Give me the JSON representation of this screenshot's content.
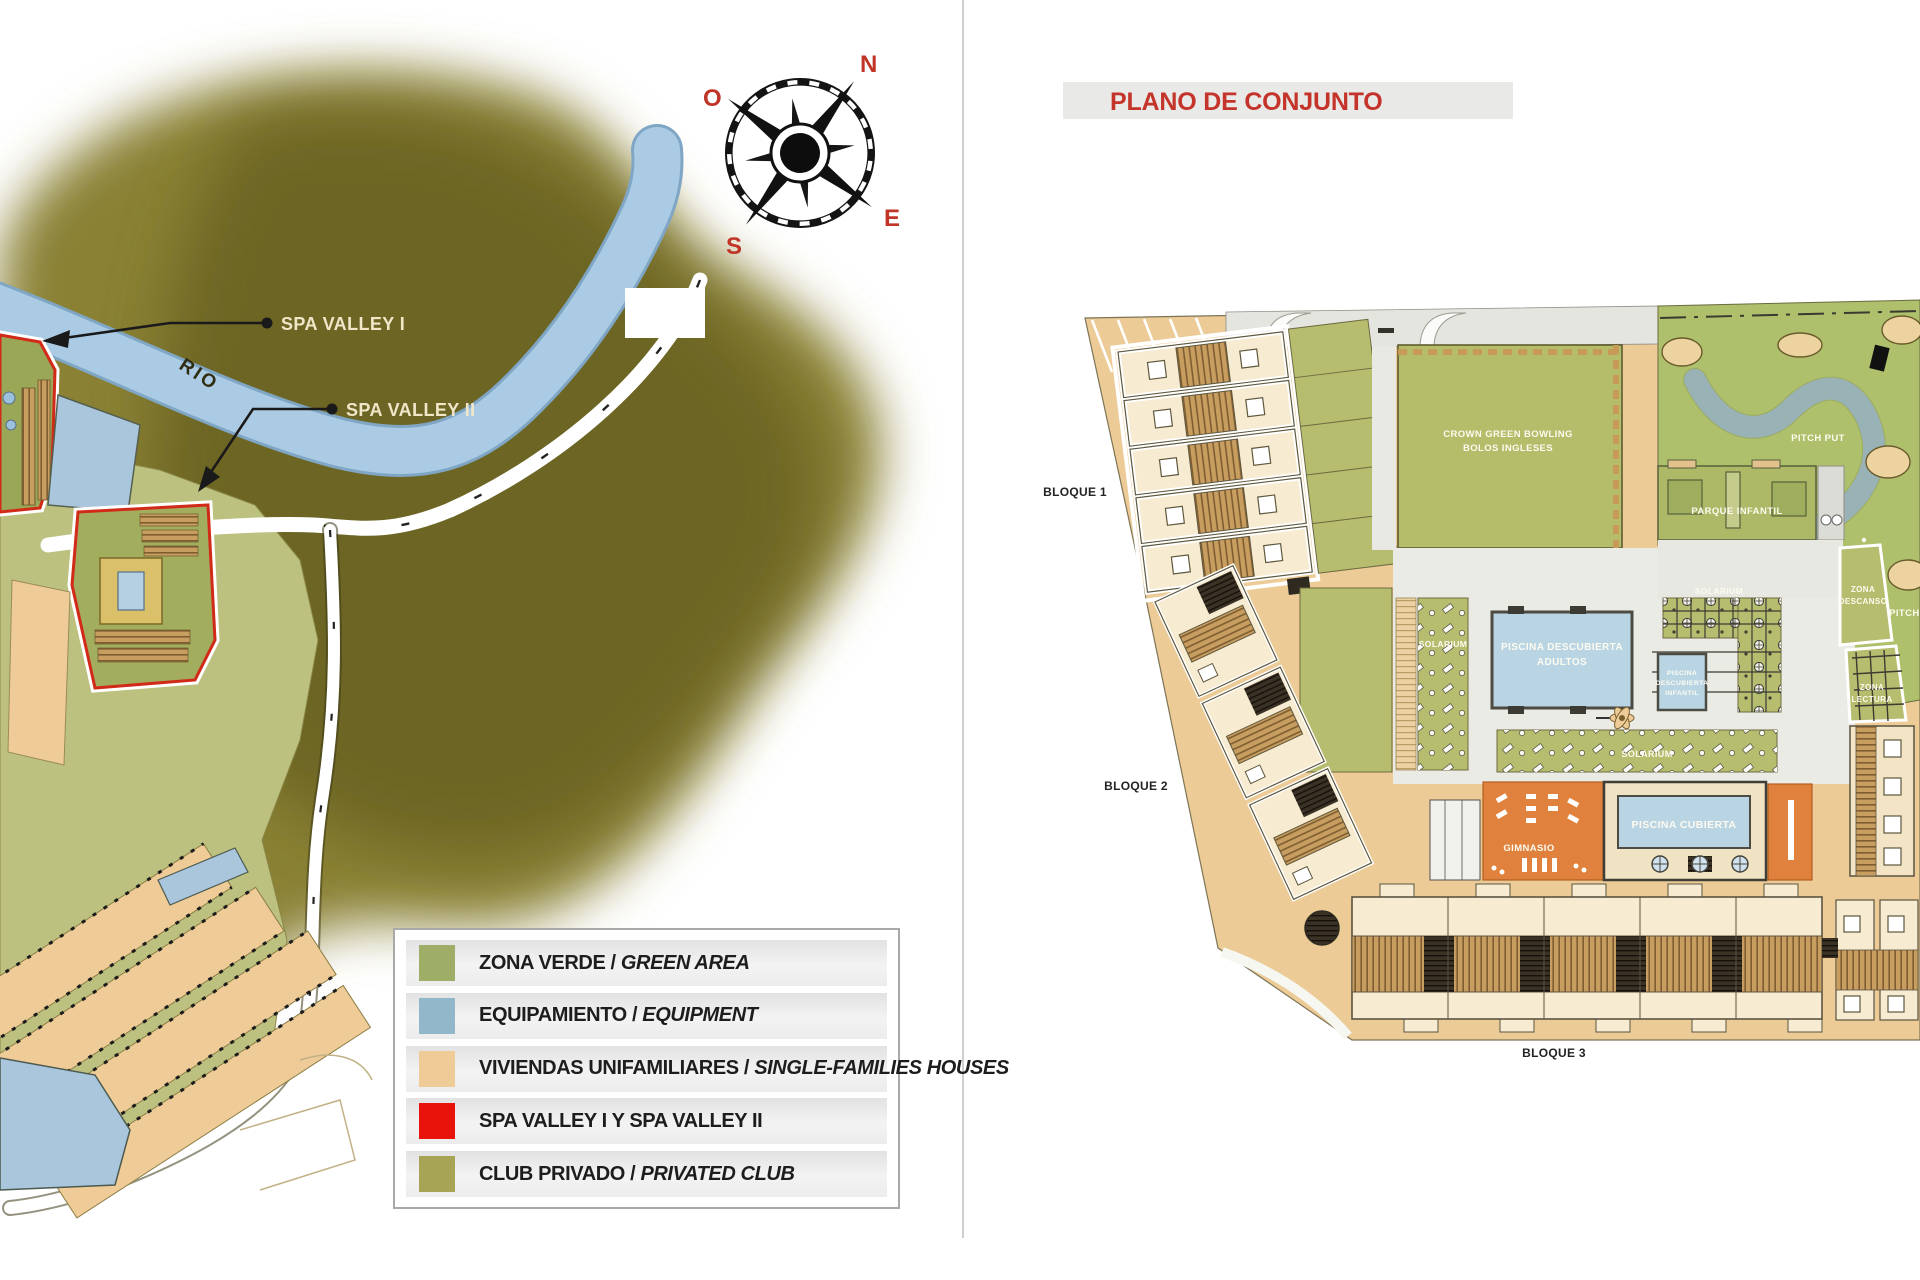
{
  "colors": {
    "accent_red": "#c5342a",
    "map_olive_dark": "#6b6320",
    "map_olive": "#8a8135",
    "dev_zone_green": "#bcc180",
    "river_blue": "#abcbe4",
    "plan_tan": "#eccb97",
    "amenity_green": "#b7bd6f",
    "bowling_green": "#b5bc6a",
    "pool_blue": "#b9d4e3",
    "gym_orange": "#e0813d",
    "building_cream": "#f7ebd1",
    "legend_swatches": [
      "#9fae66",
      "#92b7cb",
      "#eecb97",
      "#e8140c",
      "#a8a455"
    ]
  },
  "left_map": {
    "compass": {
      "n": "N",
      "e": "E",
      "s": "S",
      "o": "O"
    },
    "river": "RIO",
    "callouts": {
      "spa1": "SPA VALLEY I",
      "spa2": "SPA VALLEY II"
    },
    "legend": {
      "items": [
        {
          "color": "#9fae66",
          "primary": "ZONA VERDE",
          "separator": " / ",
          "secondary": "GREEN AREA"
        },
        {
          "color": "#92b7cb",
          "primary": "EQUIPAMIENTO",
          "separator": " / ",
          "secondary": "EQUIPMENT"
        },
        {
          "color": "#eecb97",
          "primary": "VIVIENDAS UNIFAMILIARES",
          "separator": " / ",
          "secondary": "SINGLE-FAMILIES HOUSES"
        },
        {
          "color": "#e8140c",
          "primary": "SPA VALLEY I Y SPA VALLEY II",
          "separator": "",
          "secondary": ""
        },
        {
          "color": "#a8a455",
          "primary": "CLUB PRIVADO",
          "separator": " / ",
          "secondary": "PRIVATED CLUB"
        }
      ]
    }
  },
  "right_plan": {
    "title": "PLANO DE CONJUNTO",
    "blocks": {
      "b1": "BLOQUE 1",
      "b2": "BLOQUE 2",
      "b3": "BLOQUE 3"
    },
    "areas": {
      "crown_green_bowling": "CROWN GREEN BOWLING",
      "bolos_ingleses": "BOLOS INGLESES",
      "pitch_put": "PITCH PUT",
      "parque_infantil": "PARQUE INFANTIL",
      "zona": "ZONA",
      "descanso": "DESCANSO",
      "lectura": "LECTURA",
      "solarium": "SOLARIUM",
      "piscina_descubierta": "PISCINA DESCUBIERTA",
      "adultos": "ADULTOS",
      "piscina": "PISCINA",
      "descubierta": "DESCUBIERTA",
      "infantil": "INFANTIL",
      "piscina_cubierta": "PISCINA CUBIERTA",
      "gimnasio": "GIMNASIO"
    }
  }
}
